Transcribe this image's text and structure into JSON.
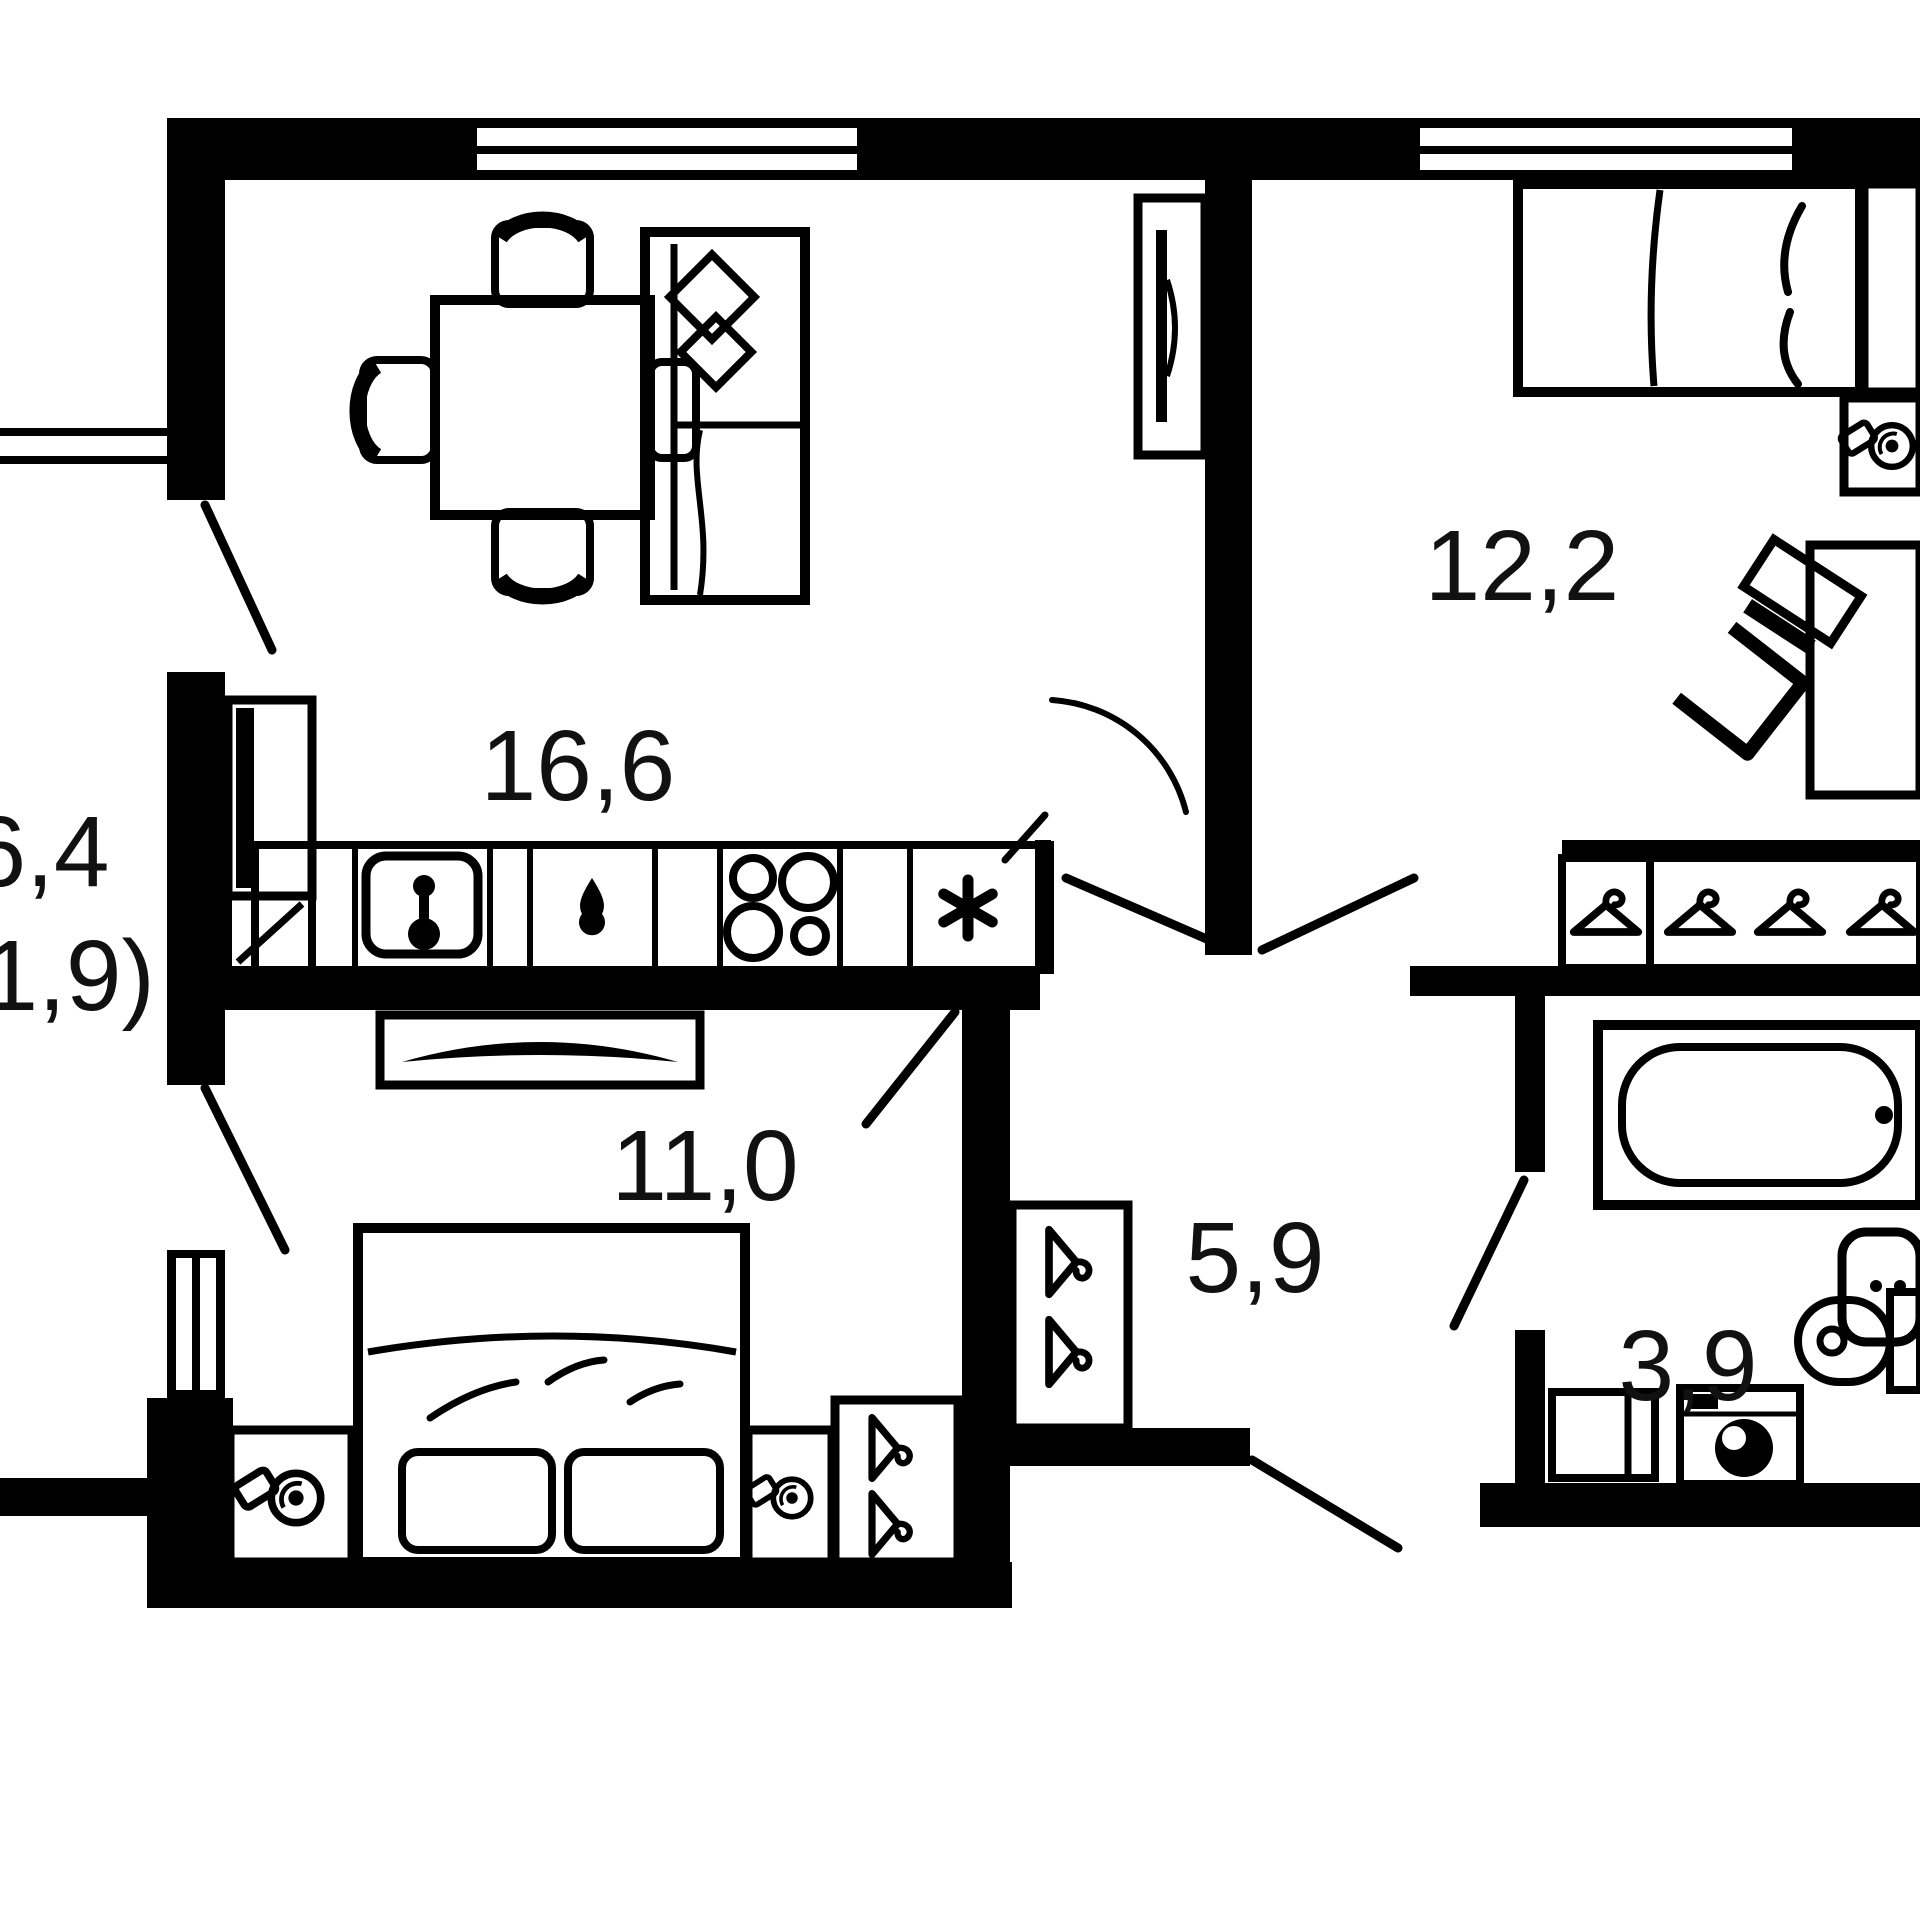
{
  "plan": {
    "type": "apartment-floor-plan",
    "colors": {
      "wall": "#000000",
      "background": "#ffffff",
      "text": "#111111"
    },
    "rooms": [
      {
        "id": "living-kitchen",
        "area_label": "16,6"
      },
      {
        "id": "bedroom-right",
        "area_label": "12,2"
      },
      {
        "id": "bedroom-left",
        "area_label": "11,0"
      },
      {
        "id": "hallway",
        "area_label": "5,9"
      },
      {
        "id": "bathroom",
        "area_label": "3,9"
      },
      {
        "id": "balcony",
        "area_label": "6,4",
        "area_label_secondary": "(1,9)"
      }
    ],
    "icons": {
      "wardrobe": "hanger-icon",
      "nightstand": "lamp-icon",
      "refrigerator": "snowflake-icon",
      "stove": "four-burners-icon",
      "kitchen-sink": "faucet-icon",
      "dishwasher": "water-drop-icon",
      "washing-machine": "drum-icon"
    }
  }
}
